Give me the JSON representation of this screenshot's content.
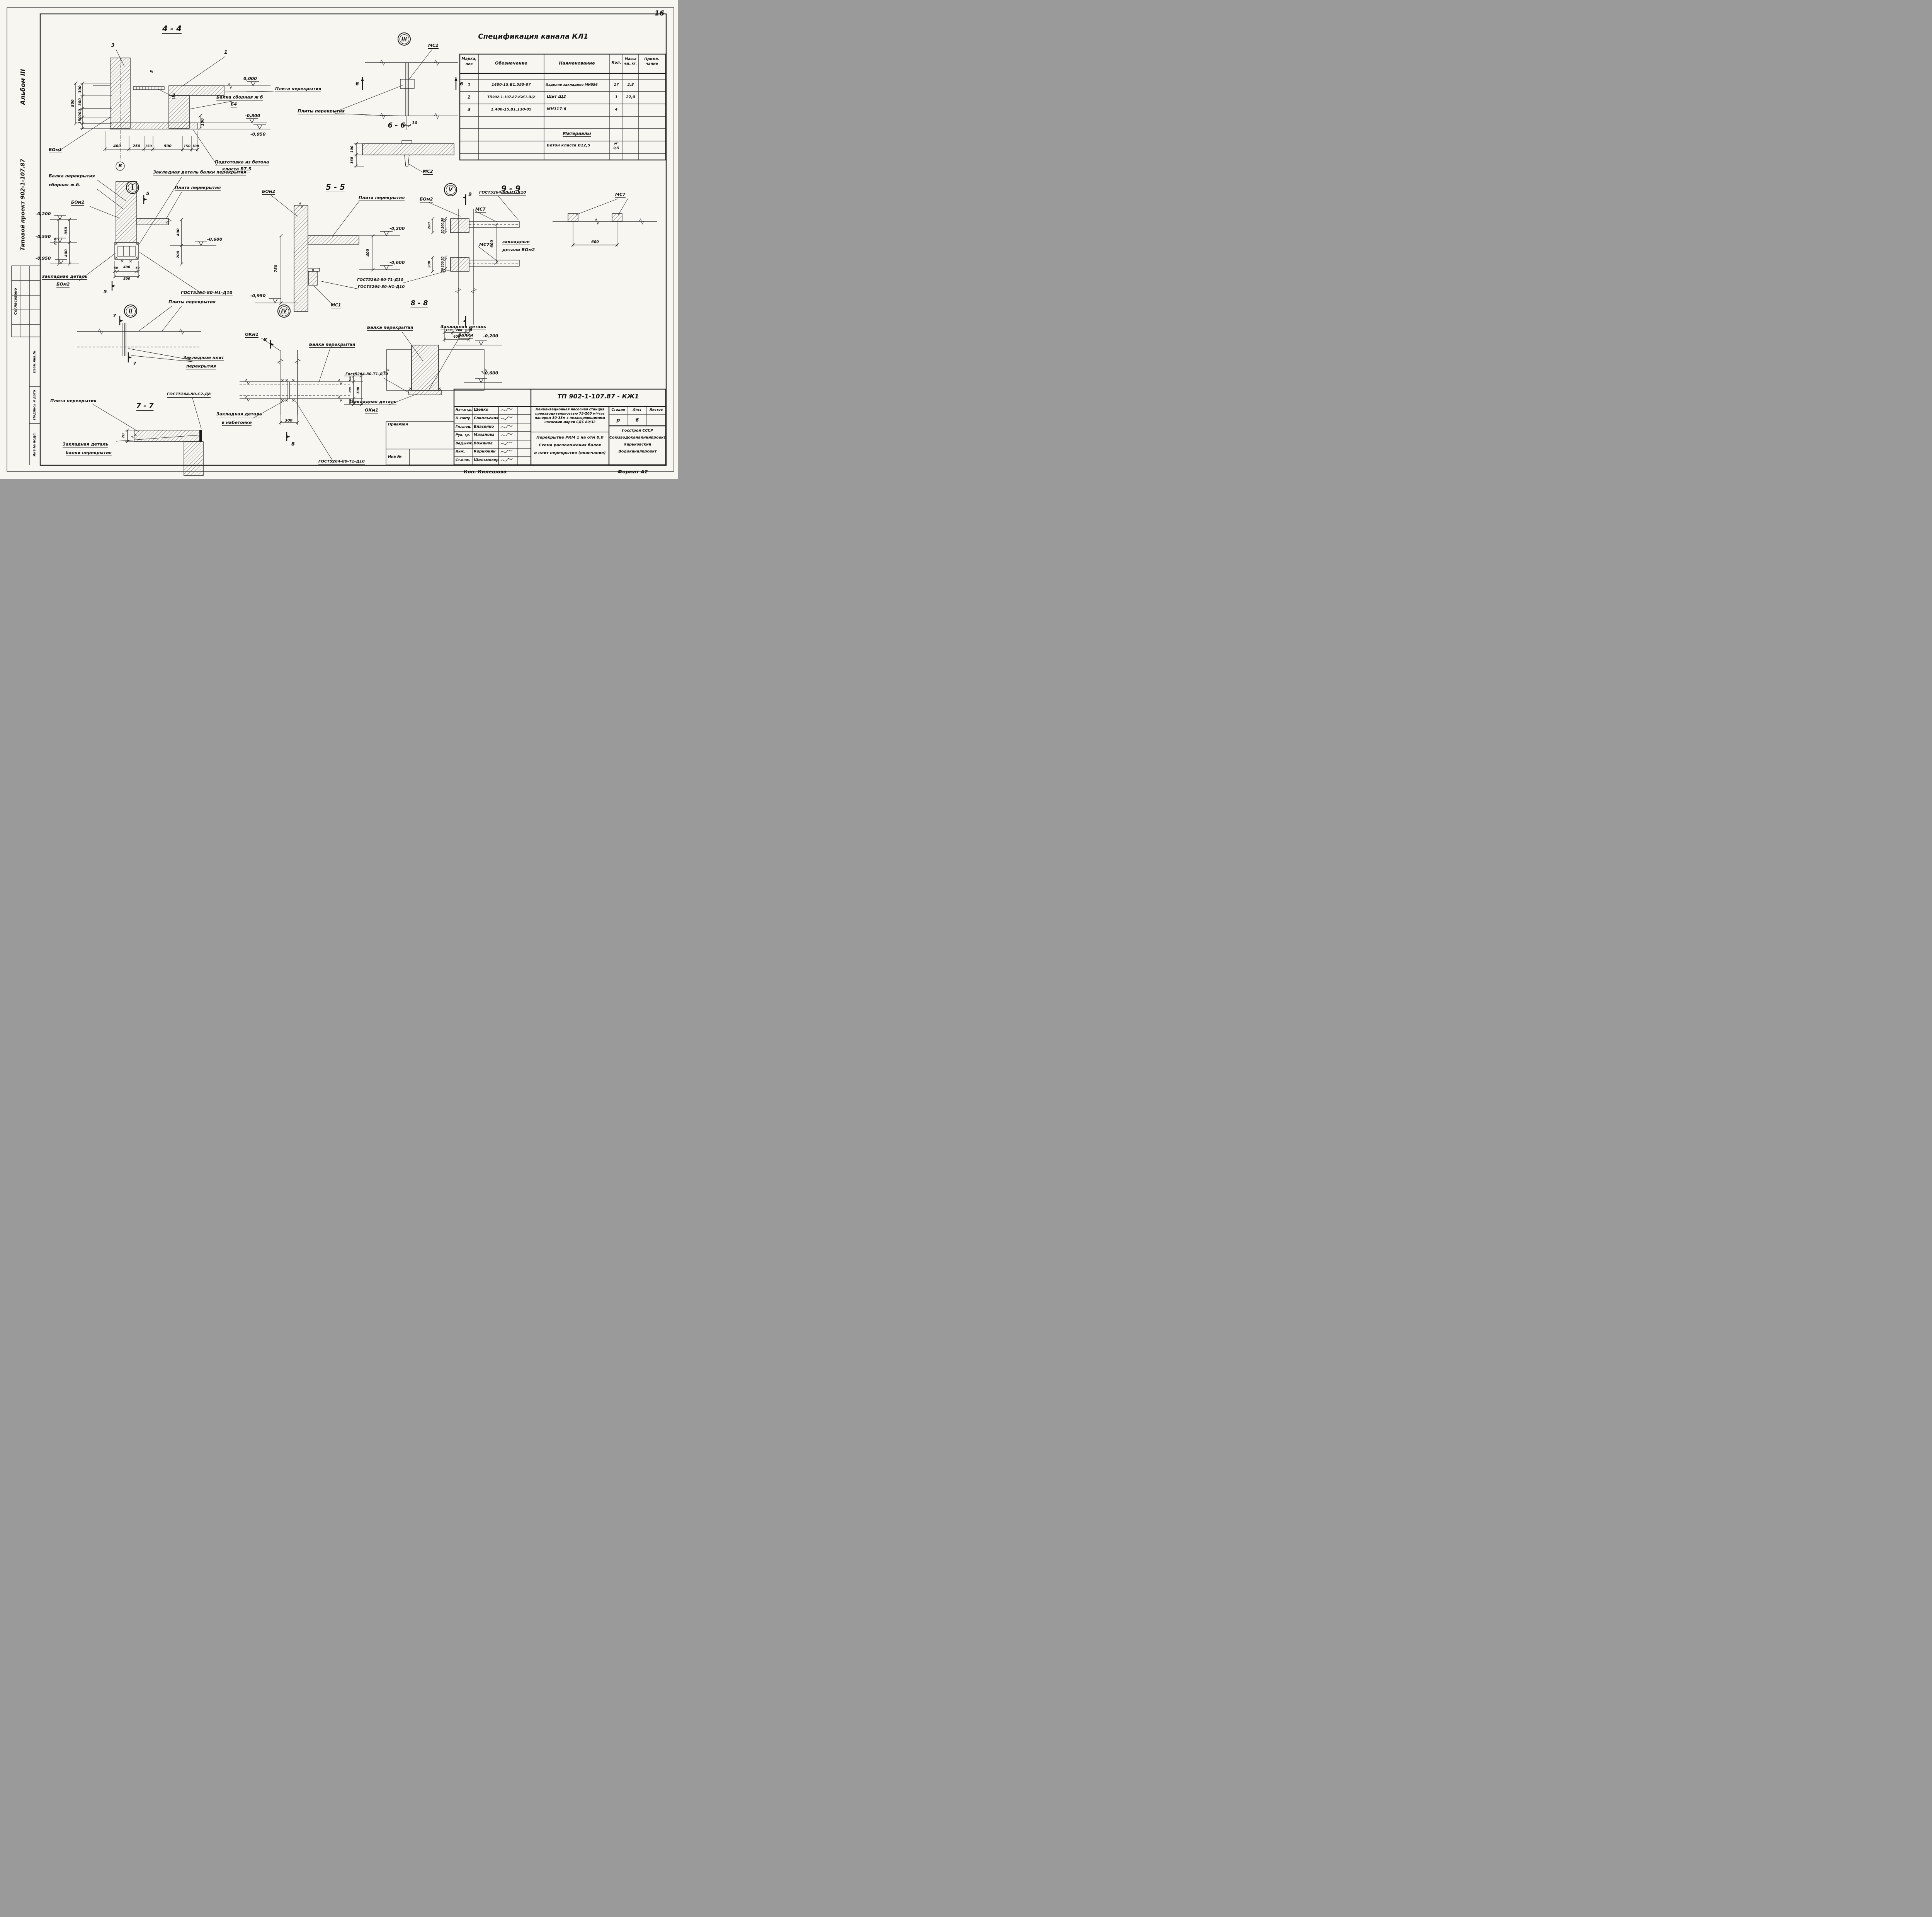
{
  "page": {
    "number": "16"
  },
  "footer": {
    "copy": "Коп.  Килешова",
    "format": "Формат А2"
  },
  "margins": {
    "album": "Альбом III",
    "project": "Типовой проект 902-1-107.87",
    "approved": "Согласовано",
    "vzam": "Взам.инв.№",
    "sign": "Подпись и дата",
    "inv": "Инв.№ подл."
  },
  "spec": {
    "title": "Спецификация  канала  КЛ1",
    "h_mark1": "Марка,",
    "h_mark2": "поз",
    "h_desig": "Обозначение",
    "h_name": "Наименование",
    "h_qty": "Кол.",
    "h_mass1": "Масса",
    "h_mass2": "ед.,кг.",
    "h_note1": "Приме-",
    "h_note2": "чание",
    "rows": [
      {
        "mark": "1",
        "desig": "1400-15.В1.550-07",
        "name": "Изделие закладное МН556",
        "qty": "17",
        "mass": "2,8"
      },
      {
        "mark": "2",
        "desig": "ТП902-1-107.87-КЖ1.Щ2",
        "name": "Щит Щ2",
        "qty": "1",
        "mass": "22,0"
      },
      {
        "mark": "3",
        "desig": "1.400-15.В1.130-05",
        "name": "МН117-6",
        "qty": "4",
        "mass": ""
      }
    ],
    "materials": "Материалы",
    "mat_name": "Бетон класса В12,5",
    "mat_unit": "м³",
    "mat_qty": "0,5"
  },
  "s44": {
    "title": "4 - 4",
    "c3": "3",
    "c1": "1",
    "c2": "2",
    "c5": "5",
    "axis": "В",
    "lvl0": "0,000",
    "lvl08": "-0,800",
    "lvl095": "-0,950",
    "plate": "Плита перекрытия",
    "beam1": "Балка сборная ж б",
    "beam2": "Б4",
    "prep1": "Подготовка из бетона",
    "prep2": "класса В7,5",
    "bom1": "БОм1",
    "v800": "800",
    "v300a": "300",
    "v300b": "300",
    "v200": "200",
    "v150": "150",
    "vr100": "100",
    "h400": "400",
    "h250": "250",
    "h150a": "150",
    "h500": "500",
    "h150b": "150",
    "h100": "100"
  },
  "sIII": {
    "num": "III",
    "mc2": "МС2",
    "m6l": "6",
    "m6r": "6",
    "d10": "10",
    "plates": "Плиты перекрытия"
  },
  "s66": {
    "title": "6 - 6",
    "v100": "100",
    "v160": "160",
    "mc2": "МС2"
  },
  "sI": {
    "num": "I",
    "m5t": "5",
    "m5b": "5",
    "beam1": "Балка перекрытия",
    "beam2": "сборная ж.б.",
    "beam3": "БОм2",
    "embtop": "Закладная деталь балки перекрытия",
    "plate": "Плита перекрытия",
    "lvl02": "-0,200",
    "lvl055": "-0,550",
    "lvl095": "-0,950",
    "lvl06": "-0,600",
    "v750": "750",
    "v350": "350",
    "v400l": "400",
    "v400r": "400",
    "v200": "200",
    "h50a": "50",
    "h400": "400",
    "h50b": "50",
    "h500": "500",
    "embb1": "Закладная деталь",
    "embb2": "БОм2",
    "gost": "ГОСТ5264-80-Н1-Д10"
  },
  "s55": {
    "title": "5 - 5",
    "bom2": "БОм2",
    "plate": "Плита перекрытия",
    "lvl02": "-0,200",
    "lvl06": "-0,600",
    "lvl095": "-0,950",
    "v400": "400",
    "v750": "750",
    "gost": "ГОСТ5264-80-Н1-Д10",
    "mc1": "МС1"
  },
  "sV": {
    "num": "V",
    "bom2": "БОм2",
    "m9t": "9",
    "m9b": "9",
    "gostT": "ГОСТ5264-80-Н1-Д10",
    "gostB": "ГОСТ5264-80-Т1-Д10",
    "mc7a": "МС7",
    "mc7b": "МС7",
    "v600": "600",
    "z1": "закладные",
    "z2": "детали БОм2",
    "d50a": "50",
    "d200a": "200",
    "d50b": "50",
    "d50c": "50",
    "d200b": "200",
    "d50d": "50",
    "o200a": "200",
    "o200b": "200",
    "b150": "150",
    "b200": "200",
    "b50": "50",
    "b400": "400"
  },
  "s99": {
    "title": "9 - 9",
    "mc7": "МС7",
    "d600": "600"
  },
  "sII": {
    "num": "II",
    "m7t": "7",
    "m7b": "7",
    "plates": "Плиты перекрытия",
    "z1": "Закладные плит",
    "z2": "перекрытия"
  },
  "s77": {
    "title": "7 - 7",
    "plate": "Плита перекрытия",
    "gost": "ГОСТ5264-80-С2-Д8",
    "v70": "70",
    "z1": "Закладная деталь",
    "z2": "балки перекрытия"
  },
  "sIV": {
    "num": "IV",
    "okm1": "ОКм1",
    "m8t": "8",
    "m8b": "8",
    "beam": "Балка перекрытия",
    "gost": "ГОСТ5264-80-Т1-Д10",
    "z1": "Закладная деталь",
    "z2": "в набетонке",
    "r100a": "100",
    "r300": "300",
    "r100b": "100",
    "r500": "500",
    "b300": "300"
  },
  "s88": {
    "title": "8 - 8",
    "beam": "Балка перекрытия",
    "zd1": "Закладная деталь",
    "zd2": "балки",
    "lvl02": "-0,200",
    "lvl06": "-0,600",
    "gost": "Гост5264-80-Т1-Д10",
    "ok1": "Закладная деталь",
    "ok2": "ОКм1"
  },
  "tb": {
    "doc": "ТП 902-1-107.87 - КЖ1",
    "rows": [
      {
        "role": "Нач.отд.",
        "name": "Шейко"
      },
      {
        "role": "Н контр",
        "name": "Сокольская"
      },
      {
        "role": "Гл.спец.",
        "name": "Власенко"
      },
      {
        "role": "Рук. гр.",
        "name": "Мазалова"
      },
      {
        "role": "Вед.инж.",
        "name": "Вожанов"
      },
      {
        "role": "Инж.",
        "name": "Корнюкин"
      },
      {
        "role": "Ст.инж.",
        "name": "Шильмовер"
      }
    ],
    "p1": "Канализационная насосная станция",
    "p2": "производительностью 75-200 м³/час",
    "p3": "напором 30-33м с незасоряющимися",
    "p4": "насосами марки СДС 80/32",
    "n1": "Перекрытие РКМ 1 на отм 0,0",
    "n2": "Схема расположения балок",
    "n3": "и плит перекрытия (окончание)",
    "stage_h": "Стадия",
    "sheet_h": "Лист",
    "sheets_h": "Листов",
    "stage": "р",
    "sheet": "6",
    "org1": "Госстрой СССР",
    "org2": "Союзводоканалниипроект",
    "org3": "Харьковский",
    "org4": "Водоканалпроект",
    "priv": "Привязан",
    "inv": "Инв №"
  }
}
